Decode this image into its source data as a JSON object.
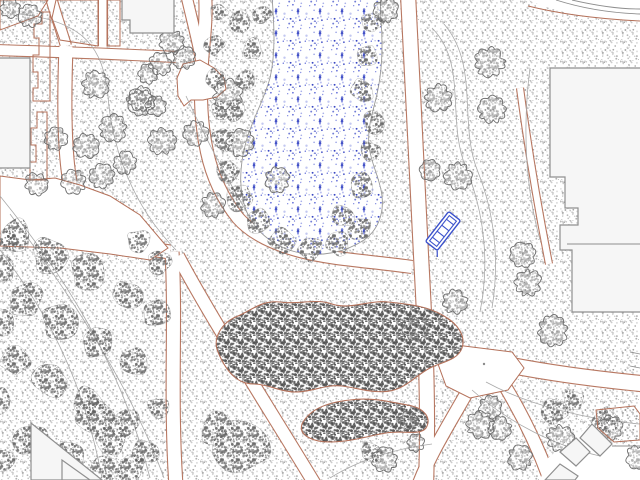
{
  "app": {
    "name": "site-plan-drawing-viewport"
  },
  "canvas": {
    "width": 640,
    "height": 480,
    "background": "#ffffff"
  },
  "palette": {
    "edge_sienna": "#b4715a",
    "building_fill": "#f6f6f6",
    "building_stroke": "#8f8f8f",
    "contour": "#a9a9a9",
    "pond_outline": "#9a9a9a",
    "tree_stroke": "#6e6e6e",
    "bench_blue": "#3c52cc",
    "white": "#ffffff",
    "mark_gray": "#8a8a8a"
  },
  "patterns": [
    {
      "id": "pat-grass",
      "tile": 20,
      "count": 40,
      "rmin": 0.5,
      "rmax": 1.1,
      "seed": 11,
      "colors": [
        "#969696",
        "#a8a8a8",
        "#bdbdbd",
        "#cfcfcf"
      ]
    },
    {
      "id": "pat-canopy",
      "tile": 16,
      "count": 55,
      "rmin": 0.7,
      "rmax": 1.4,
      "seed": 23,
      "colors": [
        "#606060",
        "#707070",
        "#828282"
      ]
    },
    {
      "id": "pat-shrub",
      "tile": 14,
      "count": 60,
      "rmin": 0.7,
      "rmax": 1.5,
      "seed": 37,
      "colors": [
        "#4f4f4f",
        "#5c5c5c",
        "#6a6a6a"
      ]
    },
    {
      "id": "pat-pond",
      "tile": 22,
      "count": 20,
      "rmin": 0.6,
      "rmax": 1.4,
      "seed": 51,
      "colors": [
        "#2c3cc0",
        "#5a66d6",
        "#9aa2e6"
      ]
    }
  ],
  "corridors": [
    {
      "name": "path-pond-west",
      "d": "M 205,-6 C 207,20 203,45 202,62 C 200,90 200,120 207,152 C 212,175 222,198 238,218 C 252,234 274,244 300,251 C 330,259 368,261 412,267",
      "w": 12
    },
    {
      "name": "path-pond-east",
      "d": "M 408,-6 C 413,80 416,170 421,255 C 425,330 429,400 426,486",
      "w": 14
    },
    {
      "name": "path-east-branch",
      "d": "M 422,342 C 458,357 540,374 646,384",
      "w": 15
    },
    {
      "name": "path-west-horiz",
      "d": "M -6,222 C 60,234 130,246 170,252",
      "w": 13
    },
    {
      "name": "path-west-vert",
      "d": "M 172,252 C 176,320 170,400 176,486",
      "w": 13
    },
    {
      "name": "path-diagonal-se",
      "d": "M 178,256 C 212,320 270,410 316,486",
      "w": 12
    },
    {
      "name": "path-upper-diag",
      "d": "M 50,-6 C 56,16 62,32 66,46",
      "w": 10
    },
    {
      "name": "path-left-corridor",
      "d": "M 66,46 C 64,100 64,150 70,182",
      "w": 13
    },
    {
      "name": "path-band",
      "d": "M -6,50 C 60,52 120,54 176,57",
      "w": 10
    },
    {
      "name": "path-slot",
      "d": "M 103,-6 L 103,46",
      "w": 8
    },
    {
      "name": "path-north",
      "d": "M 186,-6 C 192,20 198,42 201,60",
      "w": 10
    },
    {
      "name": "path-junction-south",
      "d": "M 466,394 C 448,426 430,454 418,486",
      "w": 12
    },
    {
      "name": "path-br-diagonal",
      "d": "M 500,378 C 520,410 538,446 552,486",
      "w": 12
    },
    {
      "name": "path-building-sliver",
      "d": "M 520,88 C 528,148 538,208 549,264",
      "w": 6
    }
  ],
  "white_areas": [
    {
      "name": "plaza-west",
      "d": "M 0,176 L 30,180 L 55,178 L 80,185 L 110,196 L 140,215 L 168,248 L 150,260 L 110,254 L 60,248 L 0,246 Z",
      "stroke": true
    },
    {
      "name": "junction-plaza",
      "d": "M 448,344 L 512,352 L 524,368 L 508,390 L 470,398 L 446,386 L 438,364 Z",
      "stroke": true
    },
    {
      "name": "bulb-junction",
      "d": "M 183,64 L 200,60 L 214,68 L 224,78 L 226,89 L 217,97 L 203,100 L 191,100 L 184,106 L 178,96 L 177,78 Z",
      "stroke": true
    },
    {
      "name": "road-corner",
      "d": "M 528,0 L 640,0 L 640,20 L 590,18 L 552,9 Z",
      "stroke": false
    },
    {
      "name": "plaza-bottom-right",
      "d": "M 540,480 L 548,458 L 572,438 L 592,424 L 612,446 L 640,446 L 640,480 Z",
      "stroke": false
    }
  ],
  "pond": {
    "d": "M 272,-4 C 274,24 276,52 270,78 C 264,100 252,120 246,142 C 240,164 238,188 246,210 C 254,230 272,246 296,252 C 320,258 346,252 364,240 C 378,230 384,214 382,196 C 380,178 371,164 369,146 C 367,128 373,112 377,94 C 382,72 383,46 381,20 C 380,8 381,0 380,-4 Z"
  },
  "buildings": [
    {
      "name": "building-top-left",
      "d": "M -4,58 L 30,58 L 30,168 L -4,168 Z"
    },
    {
      "name": "building-top-center",
      "d": "M 122,-4 L 174,-4 L 174,33 L 130,33 L 130,20 L 122,20 Z"
    },
    {
      "name": "building-right",
      "d": "M 550,68 L 644,68 L 644,312 L 572,312 L 572,250 L 560,250 L 560,225 L 578,225 L 578,208 L 565,208 L 565,177 L 550,177 Z"
    },
    {
      "name": "building-bl-triangle-1",
      "d": "M 31,423 L 31,480 L 102,480 Z"
    },
    {
      "name": "building-bl-triangle-2",
      "d": "M 62,460 L 62,480 L 90,480 Z"
    },
    {
      "name": "building-br-1",
      "d": "M 592,424 L 612,444 L 600,456 L 580,438 Z"
    },
    {
      "name": "building-br-2",
      "d": "M 560,452 L 576,438 L 590,452 L 576,466 Z"
    },
    {
      "name": "building-br-3",
      "d": "M 545,480 L 560,464 L 578,476 L 575,480 Z"
    }
  ],
  "building_lines": [
    {
      "d": "M 567,244 L 640,244"
    },
    {
      "d": "M 612,446 L 640,446"
    }
  ],
  "road_lines": [
    {
      "d": "M 556,0 C 584,9 612,13 640,14"
    },
    {
      "d": "M 572,0 C 598,6 622,9 640,9"
    }
  ],
  "grass_edges": [
    {
      "name": "strip-1",
      "d": "M 50,12 L 50,101 L 33,101 L 33,88 L 38,88 L 38,72 L 33,72 L 33,55 L 39,55 L 39,38 L 34,38 L 34,24 L 42,24 L 42,12 Z"
    },
    {
      "name": "strip-2",
      "d": "M 47,112 L 47,180 L 30,180 L 30,162 L 36,162 L 36,145 L 31,145 L 31,128 L 37,128 L 37,112 Z"
    },
    {
      "name": "corner-wedge",
      "d": "M 0,0 L 48,0 L 38,16 L 0,30 Z"
    },
    {
      "name": "band-a",
      "d": "M 56,0 L 98,0 L 98,46 L 60,40 L 52,18 Z"
    },
    {
      "name": "band-b",
      "d": "M 107,0 L 120,0 L 120,46 L 107,46 Z"
    },
    {
      "name": "road-corner-edge",
      "d": "M 528,6 C 560,14 600,19 640,21"
    }
  ],
  "grass_patches": [
    {
      "name": "grass-patch-br",
      "d": "M 596,410 L 634,406 L 640,414 L 640,440 L 614,442 L 598,428 Z"
    }
  ],
  "shrubs": [
    {
      "name": "shrub-mass-center",
      "d": "M 218,352 C 212,338 222,322 238,316 C 252,310 262,300 280,302 C 298,305 315,298 332,304 C 350,310 368,300 388,302 C 408,304 428,306 444,316 C 458,324 466,336 462,348 C 458,360 442,362 430,368 C 418,374 408,386 394,390 C 378,395 358,388 342,386 C 326,384 312,392 296,392 C 280,392 268,384 254,384 C 240,384 228,376 218,352 Z"
    },
    {
      "name": "shrub-band-south",
      "d": "M 302,424 C 310,408 330,402 350,400 C 372,397 392,402 412,406 C 424,409 432,418 426,428 C 420,436 402,430 386,433 C 368,436 350,442 330,442 C 314,442 298,436 302,424 Z"
    }
  ],
  "canopy_blobs": [
    [
      15,
      235,
      16
    ],
    [
      50,
      255,
      18
    ],
    [
      88,
      272,
      17
    ],
    [
      125,
      295,
      16
    ],
    [
      155,
      315,
      14
    ],
    [
      25,
      300,
      17
    ],
    [
      60,
      322,
      18
    ],
    [
      98,
      342,
      16
    ],
    [
      135,
      362,
      14
    ],
    [
      15,
      360,
      16
    ],
    [
      50,
      382,
      17
    ],
    [
      88,
      402,
      16
    ],
    [
      125,
      422,
      14
    ],
    [
      30,
      440,
      17
    ],
    [
      68,
      458,
      16
    ],
    [
      105,
      470,
      14
    ],
    [
      145,
      452,
      13
    ],
    [
      160,
      262,
      12
    ],
    [
      0,
      270,
      14
    ],
    [
      0,
      322,
      13
    ],
    [
      0,
      402,
      14
    ],
    [
      0,
      462,
      13
    ],
    [
      158,
      408,
      12
    ],
    [
      140,
      240,
      12
    ],
    [
      8,
      240,
      12
    ],
    [
      240,
      448,
      28
    ],
    [
      215,
      428,
      16
    ],
    [
      95,
      417,
      18
    ],
    [
      112,
      442,
      16
    ],
    [
      130,
      468,
      14
    ],
    [
      218,
      12,
      10
    ],
    [
      214,
      45,
      10
    ],
    [
      216,
      78,
      10
    ],
    [
      220,
      110,
      10
    ],
    [
      222,
      140,
      11
    ],
    [
      228,
      170,
      12
    ],
    [
      240,
      198,
      13
    ],
    [
      258,
      222,
      14
    ],
    [
      282,
      240,
      14
    ],
    [
      310,
      249,
      13
    ],
    [
      338,
      243,
      12
    ],
    [
      360,
      229,
      12
    ],
    [
      344,
      216,
      11
    ],
    [
      362,
      186,
      12
    ],
    [
      370,
      152,
      11
    ],
    [
      374,
      122,
      11
    ],
    [
      363,
      90,
      12
    ],
    [
      368,
      56,
      12
    ],
    [
      372,
      22,
      11
    ],
    [
      240,
      20,
      11
    ],
    [
      252,
      48,
      11
    ],
    [
      246,
      80,
      11
    ],
    [
      236,
      110,
      11
    ],
    [
      262,
      14,
      10
    ],
    [
      552,
      412,
      15
    ],
    [
      573,
      400,
      11
    ],
    [
      605,
      420,
      13
    ],
    [
      370,
      452,
      11
    ]
  ],
  "trees": [
    [
      95,
      85,
      12
    ],
    [
      113,
      128,
      12
    ],
    [
      86,
      146,
      11
    ],
    [
      141,
      101,
      12
    ],
    [
      162,
      141,
      12
    ],
    [
      56,
      139,
      10
    ],
    [
      36,
      184,
      10
    ],
    [
      74,
      182,
      11
    ],
    [
      102,
      176,
      11
    ],
    [
      125,
      163,
      10
    ],
    [
      172,
      42,
      11
    ],
    [
      184,
      58,
      10
    ],
    [
      160,
      64,
      10
    ],
    [
      148,
      74,
      9
    ],
    [
      140,
      100,
      10
    ],
    [
      156,
      106,
      9
    ],
    [
      228,
      94,
      13
    ],
    [
      196,
      133,
      11
    ],
    [
      240,
      143,
      12
    ],
    [
      277,
      180,
      11
    ],
    [
      213,
      205,
      11
    ],
    [
      386,
      10,
      11
    ],
    [
      438,
      98,
      12
    ],
    [
      490,
      62,
      13
    ],
    [
      492,
      110,
      12
    ],
    [
      458,
      176,
      12
    ],
    [
      430,
      170,
      9
    ],
    [
      523,
      255,
      11
    ],
    [
      528,
      283,
      12
    ],
    [
      553,
      331,
      13
    ],
    [
      455,
      302,
      11
    ],
    [
      415,
      328,
      11
    ],
    [
      408,
      420,
      8
    ],
    [
      416,
      443,
      8
    ],
    [
      385,
      460,
      11
    ],
    [
      490,
      407,
      10
    ],
    [
      500,
      428,
      10
    ],
    [
      610,
      428,
      11
    ],
    [
      560,
      438,
      12
    ],
    [
      520,
      458,
      11
    ],
    [
      480,
      425,
      12
    ],
    [
      637,
      457,
      10
    ],
    [
      10,
      8,
      9
    ],
    [
      30,
      16,
      10
    ]
  ],
  "contours": [
    {
      "d": "M 20,14 C 85,22 103,48 108,96 C 112,148 132,205 176,250"
    },
    {
      "d": "M 0,196 C 60,270 120,360 150,478"
    },
    {
      "d": "M 10,214 C 72,296 132,390 164,478"
    },
    {
      "d": "M 0,250 C 42,306 82,372 102,478"
    },
    {
      "d": "M 432,28 C 468,64 446,120 466,168 C 484,212 490,262 480,312"
    },
    {
      "d": "M 444,24 C 480,66 458,124 478,172 C 494,212 500,260 492,308"
    },
    {
      "d": "M 186,96 C 212,152 238,198 254,224"
    },
    {
      "d": "M 330,478 C 362,458 400,448 432,444"
    },
    {
      "d": "M 472,390 C 510,424 556,446 600,456"
    },
    {
      "d": "M 486,382 C 530,406 590,420 640,424"
    },
    {
      "d": "M 530,68 C 522,130 526,190 540,240"
    }
  ],
  "bench": {
    "cx": 443,
    "cy": 231,
    "width": 38,
    "height": 15,
    "angle": -52,
    "inner_margin": 3,
    "stripes": 4
  },
  "marks": {
    "junction_dot": {
      "x": 484,
      "y": 364,
      "r": 1.2
    },
    "edge_ticks": [
      {
        "d": "M 630,352 L 640,354"
      },
      {
        "d": "M 630,366 L 640,368"
      }
    ]
  }
}
